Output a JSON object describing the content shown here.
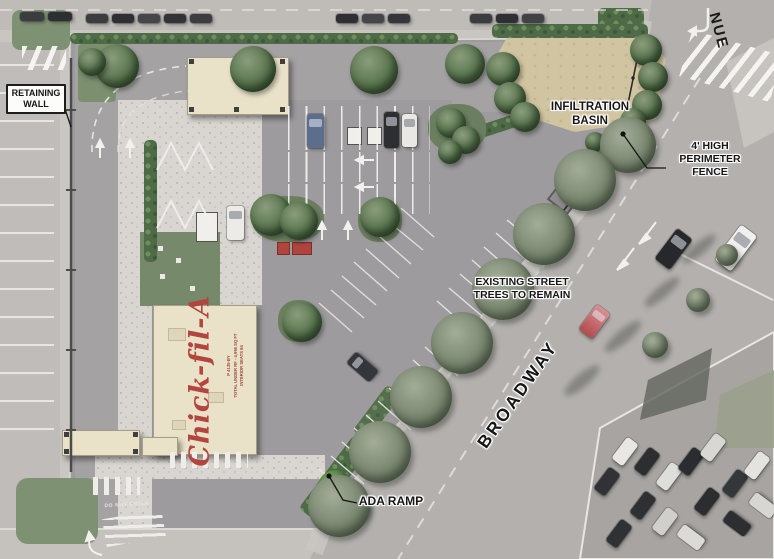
{
  "plan": {
    "type": "site-plan-rendering",
    "brand_logo": "Chick-fil-A",
    "building_annotation": "P 4135-BY\nTOTAL UNDER RF - 4,996 SQ FT\nINTERIOR SEATS 84",
    "labels": {
      "retaining_wall": "RETAINING\nWALL",
      "infiltration_basin": "INFILTRATION\nBASIN",
      "perimeter_fence": "4' HIGH\nPERIMETER\nFENCE",
      "existing_trees": "EXISTING STREET\nTREES TO REMAIN",
      "ada_ramp": "ADA RAMP"
    },
    "streets": {
      "broadway": "BROADWAY",
      "avenue_partial": "NUE"
    },
    "pavement_text": {
      "do_not_enter": "DO NOT ENTER"
    },
    "colors": {
      "logo_red": "#b2453e",
      "building_cream": "#e9e1c8",
      "basin_tan": "#d1c4a1",
      "landscape_green": "#5f7a54",
      "street_gray": "#b3b0ad",
      "label_text": "#161616"
    }
  }
}
